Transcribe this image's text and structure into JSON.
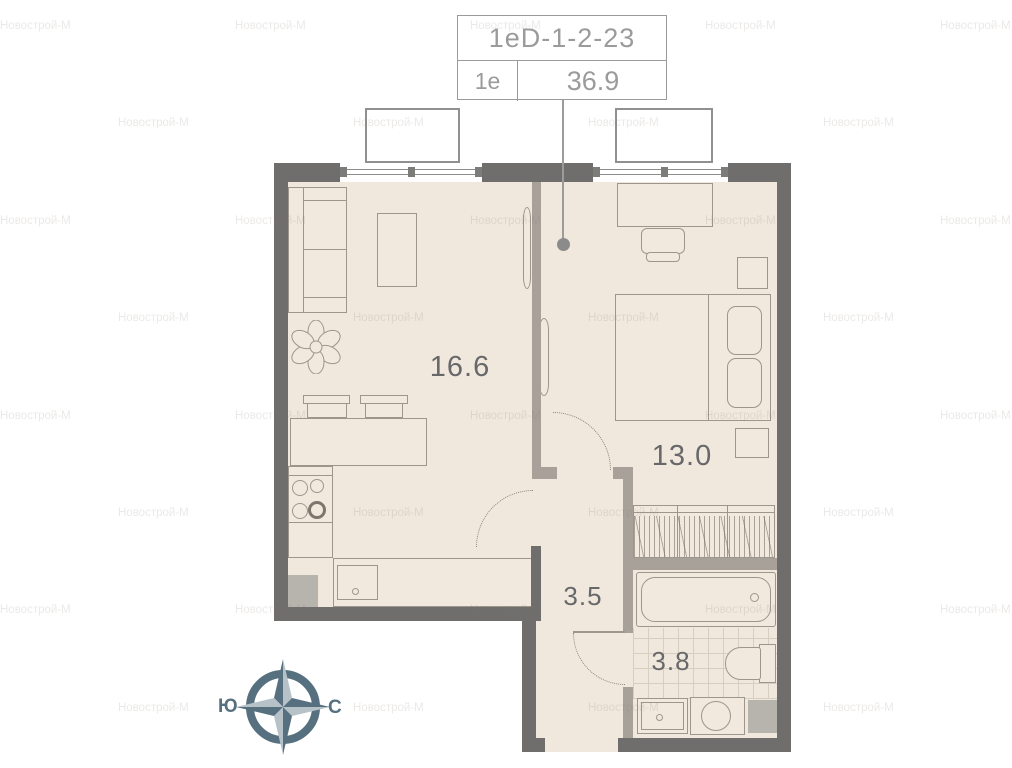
{
  "watermark": {
    "text": "Новострой-М"
  },
  "title_block": {
    "unit_code": "1eD-1-2-23",
    "layout_type": "1e",
    "total_area": "36.9"
  },
  "rooms": {
    "living": {
      "area": "16.6"
    },
    "bedroom": {
      "area": "13.0"
    },
    "hallway": {
      "area": "3.5"
    },
    "bathroom": {
      "area": "3.8"
    }
  },
  "compass": {
    "south": "Ю",
    "north": "С"
  },
  "colors": {
    "wall_dark": "#6f6e6c",
    "wall_light": "#a7a19a",
    "floor": "#f0e8dd",
    "furniture_fill": "#f1e9de",
    "line": "#9d968c",
    "tile_line": "#d7cec2",
    "shaft_fill": "#b7b3ad",
    "label_text": "#68686a",
    "title_text": "#9b9b9b",
    "slate_dark": "#56707f",
    "slate_light": "#b6c1c8",
    "watermark_tint": "rgba(130,120,105,0.16)"
  }
}
